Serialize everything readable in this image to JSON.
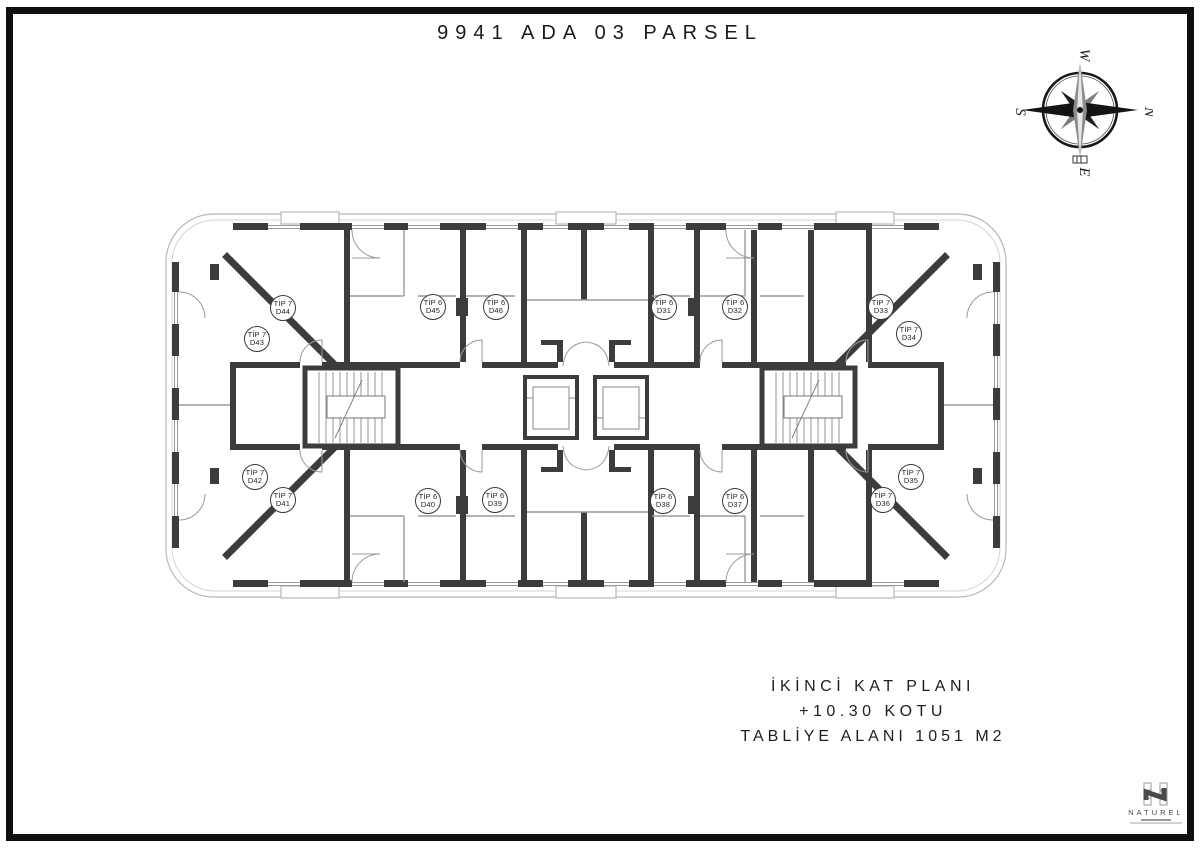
{
  "title": "9941 ADA 03 PARSEL",
  "compass": {
    "w": "W",
    "n": "N",
    "s": "S",
    "e": "E"
  },
  "plan": {
    "units": [
      {
        "tip": "TİP 7",
        "no": "D44",
        "x": 283,
        "y": 308
      },
      {
        "tip": "TİP 6",
        "no": "D45",
        "x": 433,
        "y": 307
      },
      {
        "tip": "TİP 6",
        "no": "D46",
        "x": 496,
        "y": 307
      },
      {
        "tip": "TİP 6",
        "no": "D31",
        "x": 664,
        "y": 307
      },
      {
        "tip": "TİP 6",
        "no": "D32",
        "x": 735,
        "y": 307
      },
      {
        "tip": "TİP 7",
        "no": "D33",
        "x": 881,
        "y": 307
      },
      {
        "tip": "TİP 7",
        "no": "D43",
        "x": 257,
        "y": 339
      },
      {
        "tip": "TİP 7",
        "no": "D34",
        "x": 909,
        "y": 334
      },
      {
        "tip": "TİP 7",
        "no": "D42",
        "x": 255,
        "y": 477
      },
      {
        "tip": "TİP 7",
        "no": "D35",
        "x": 911,
        "y": 477
      },
      {
        "tip": "TİP 7",
        "no": "D41",
        "x": 283,
        "y": 500
      },
      {
        "tip": "TİP 6",
        "no": "D40",
        "x": 428,
        "y": 501
      },
      {
        "tip": "TİP 6",
        "no": "D39",
        "x": 495,
        "y": 500
      },
      {
        "tip": "TİP 6",
        "no": "D38",
        "x": 663,
        "y": 501
      },
      {
        "tip": "TİP 6",
        "no": "D37",
        "x": 735,
        "y": 501
      },
      {
        "tip": "TİP 7",
        "no": "D36",
        "x": 883,
        "y": 500
      }
    ]
  },
  "info_block": {
    "line1": "İKİNCİ KAT PLANI",
    "line2": "+10.30 KOTU",
    "line3": "TABLİYE ALANI 1051 M2"
  },
  "logo": {
    "name": "NATUREL"
  }
}
